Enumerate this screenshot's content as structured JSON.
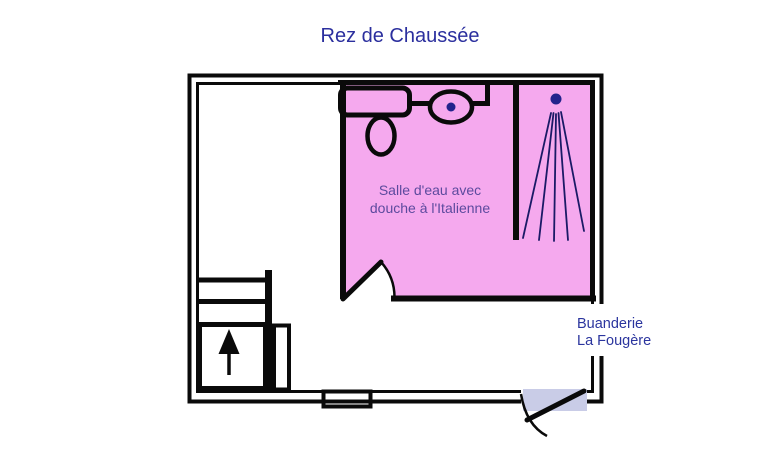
{
  "title": "Rez de Chaussée",
  "plan": {
    "bathroom_label_line1": "Salle d'eau avec",
    "bathroom_label_line2": "douche à l'Italienne",
    "building_label_line1": "Buanderie",
    "building_label_line2": "La Fougère"
  },
  "fixtures": {
    "sink": "sink-icon",
    "toilet": "toilet-icon",
    "washbasin": "washbasin-icon",
    "shower": "shower-spray-icon",
    "staircase": "staircase-up-arrow-icon",
    "window": "window-icon",
    "entrance_door": "door-swing-icon"
  },
  "colors": {
    "title_text": "#2B2F9E",
    "bathroom_fill": "#F5A9EE",
    "bathroom_label_text": "#5C4A9E",
    "building_label_text": "#2B359E",
    "walls": "#0A0A0A",
    "fixture_dot": "#22228C",
    "spray_lines": "#1A1A66",
    "entrance_door_fill": "#C9CCE7"
  }
}
